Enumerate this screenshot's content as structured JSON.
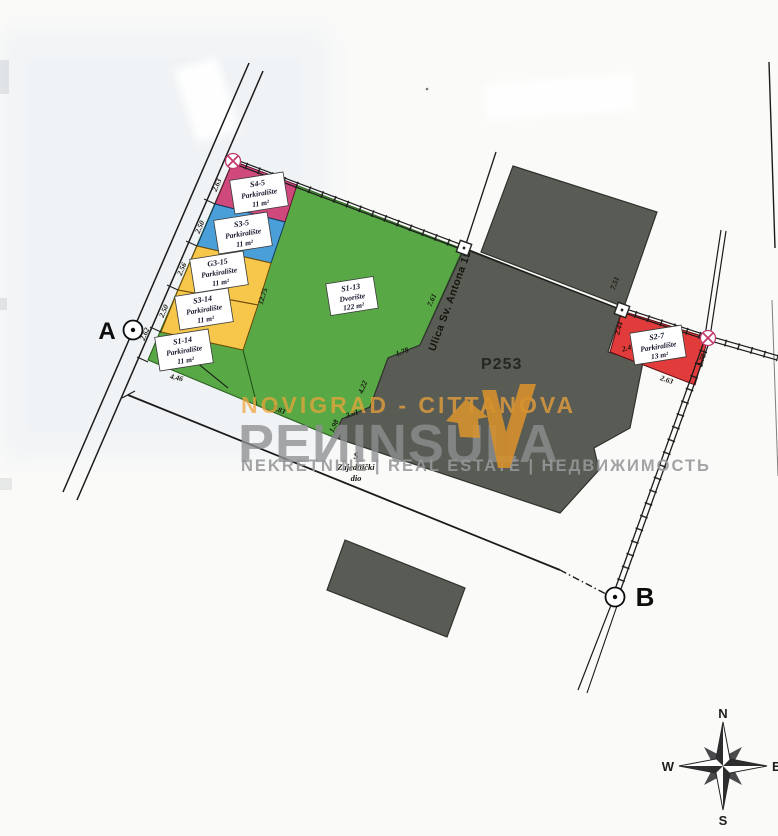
{
  "watermark": {
    "location": "NOVIGRAD - CITTANOVA",
    "brand": "PEИINSULA",
    "tagline": "NEKRETNINE | REAL ESTATE | НЕДВИЖИМОСТЬ"
  },
  "points": {
    "a": "A",
    "b": "B"
  },
  "compass": {
    "n": "N",
    "e": "E",
    "s": "S",
    "w": "W"
  },
  "street_label": "Ulica Sv. Antona 15",
  "building_label": "P253",
  "common_area": {
    "s": "S",
    "line1": "Zajednički",
    "line2": "dio"
  },
  "parcels": [
    {
      "code": "S4-5",
      "usage": "Parkiralište",
      "area": "11 m²",
      "color": "#d0497c"
    },
    {
      "code": "S3-5",
      "usage": "Parkiralište",
      "area": "11 m²",
      "color": "#4a9fd8"
    },
    {
      "code": "G3-15",
      "usage": "Parkiralište",
      "area": "11 m²",
      "color": "#f6c74a"
    },
    {
      "code": "S3-14",
      "usage": "Parkiralište",
      "area": "11 m²",
      "color": "#f6c74a"
    },
    {
      "code": "S1-14",
      "usage": "Parkiralište",
      "area": "11 m²",
      "color": "#58a846"
    },
    {
      "code": "S1-13",
      "usage": "Dvorište",
      "area": "122 m²",
      "color": "#58a846"
    },
    {
      "code": "S2-7",
      "usage": "Parkiralište",
      "area": "13 m²",
      "color": "#e23b3b"
    }
  ],
  "dimensions": [
    "2.63",
    "2.50",
    "2.56",
    "2.50",
    "2.62",
    "4.46",
    "12.75",
    "7.61",
    "7.51",
    "1.78",
    "4.22",
    "3.01",
    "1.98",
    "7.83",
    "2.44",
    "2.41",
    "2.78",
    "2.63"
  ],
  "colors": {
    "building": "#585c54",
    "green": "#58a846",
    "marker_x": "#c23a6e"
  }
}
